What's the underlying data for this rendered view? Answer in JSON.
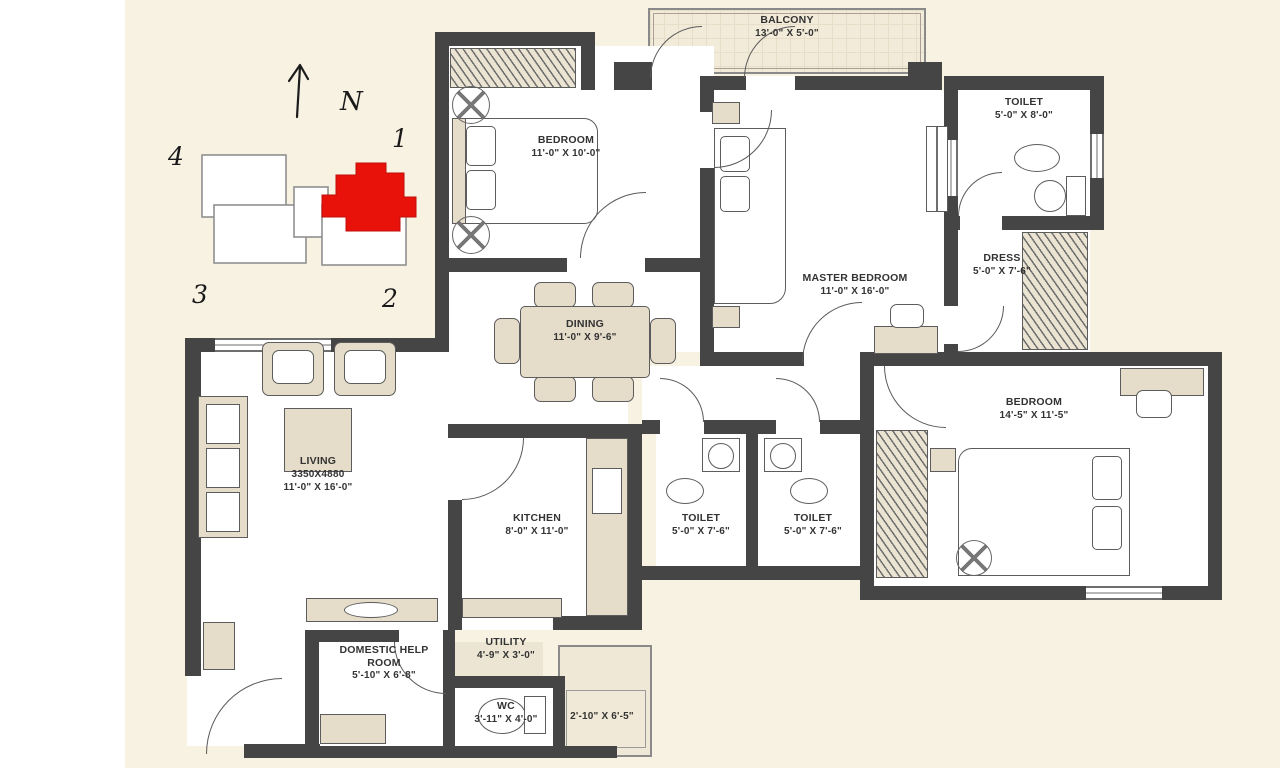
{
  "keyplan": {
    "north_label": "N",
    "corner_labels": {
      "top_left": "4",
      "top_right": "1",
      "bottom_left": "3",
      "bottom_right": "2"
    },
    "highlight_color": "#e8120b"
  },
  "rooms": {
    "balcony": {
      "name": "BALCONY",
      "dims": "13'-0\" X 5'-0\""
    },
    "bedroom1": {
      "name": "BEDROOM",
      "dims": "11'-0\" X 10'-0\""
    },
    "toilet_top": {
      "name": "TOILET",
      "dims": "5'-0\" X 8'-0\""
    },
    "master_bedroom": {
      "name": "MASTER BEDROOM",
      "dims": "11'-0\" X 16'-0\""
    },
    "dress": {
      "name": "DRESS",
      "dims": "5'-0\" X 7'-6\""
    },
    "dining": {
      "name": "DINING",
      "dims": "11'-0\" X 9'-6\""
    },
    "living": {
      "name": "LIVING",
      "metric": "3350X4880",
      "dims": "11'-0\" X 16'-0\""
    },
    "kitchen": {
      "name": "KITCHEN",
      "dims": "8'-0\" X 11'-0\""
    },
    "toilet_mid_left": {
      "name": "TOILET",
      "dims": "5'-0\" X 7'-6\""
    },
    "toilet_mid_right": {
      "name": "TOILET",
      "dims": "5'-0\" X 7'-6\""
    },
    "bedroom2": {
      "name": "BEDROOM",
      "dims": "14'-5\" X 11'-5\""
    },
    "domestic_help": {
      "name": "DOMESTIC HELP ROOM",
      "dims": "5'-10\" X 6'-8\""
    },
    "utility": {
      "name": "UTILITY",
      "dims": "4'-9\" X 3'-0\""
    },
    "wc": {
      "name": "WC",
      "dims": "3'-11\" X 4'-0\""
    },
    "side_yard": {
      "dims": "2'-10\" X 6'-5\""
    }
  },
  "colors": {
    "wall": "#454545",
    "canvas": "#f8f2e2",
    "furniture": "#e5dcc9",
    "highlight": "#e8120b"
  }
}
